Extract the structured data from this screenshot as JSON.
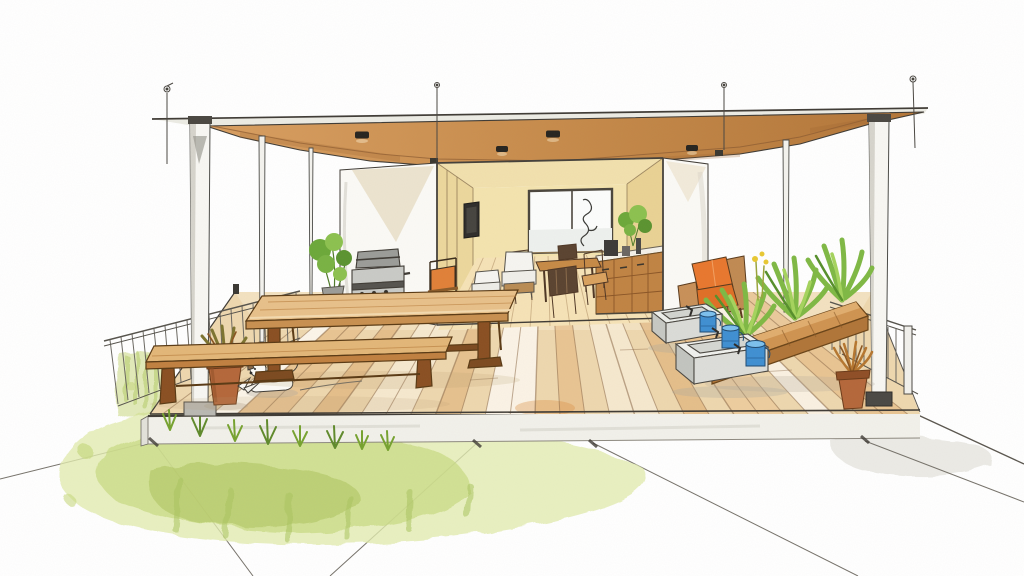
{
  "image": {
    "alt": "Watercolor and ink architectural sketch of a rooftop terrace: a wooden deck with a long dining table and two benches under a flat brown canopy on slender white posts with suspension cables, an open room at the back with pale yellow walls, a window, wall TV, kitchen cabinets and seating, gray planter boxes with blue watering cans and a wooden trough of green plants on the right, railings on both sides, terracotta pots, a small white puppy on the deck, and yellow-green grass with concrete pavement in the foreground.",
    "medium": "watercolor and ink sketch",
    "subject": "rooftop terrace with pergola canopy and open living room",
    "background": "white paper"
  },
  "palette": {
    "canopy_brown": "#c98e4e",
    "wall_yellow": "#f2e1aa",
    "deck_tan": "#eed7ae",
    "wood_dark": "#7c4a20",
    "wood_mid": "#c08848",
    "grass_green": "#c3d67e",
    "leaf_green": "#7cb644",
    "terracotta": "#b4673a",
    "accent_orange": "#e8772e",
    "accent_blue": "#3f8fd2",
    "concrete_gray": "#d9dad6",
    "ink": "#3f3b35"
  },
  "scene": {
    "canopy": {
      "downlights": 4,
      "suspension_cables": 4,
      "hanger_brackets": 2
    },
    "structure": {
      "posts": 5,
      "railings": 2
    },
    "room": {
      "window_panes": 2,
      "tv": 1,
      "kitchen_cabinet_bays": 3,
      "dining_chairs": 4,
      "white_armchairs": 2,
      "counter_plant": 1
    },
    "terrace": {
      "long_table": 1,
      "benches": 2,
      "grill": 1,
      "gray_planter_boxes": 2,
      "blue_watering_cans": 3,
      "wood_trough_planter": 1,
      "terracotta_pots": 2,
      "orange_armchair": 1,
      "orange_back_chair": 1,
      "puppy": 1
    },
    "foreground": {
      "grass_wash": "yellow-green",
      "grass_tufts": 8,
      "pavement_joints": 6
    }
  }
}
